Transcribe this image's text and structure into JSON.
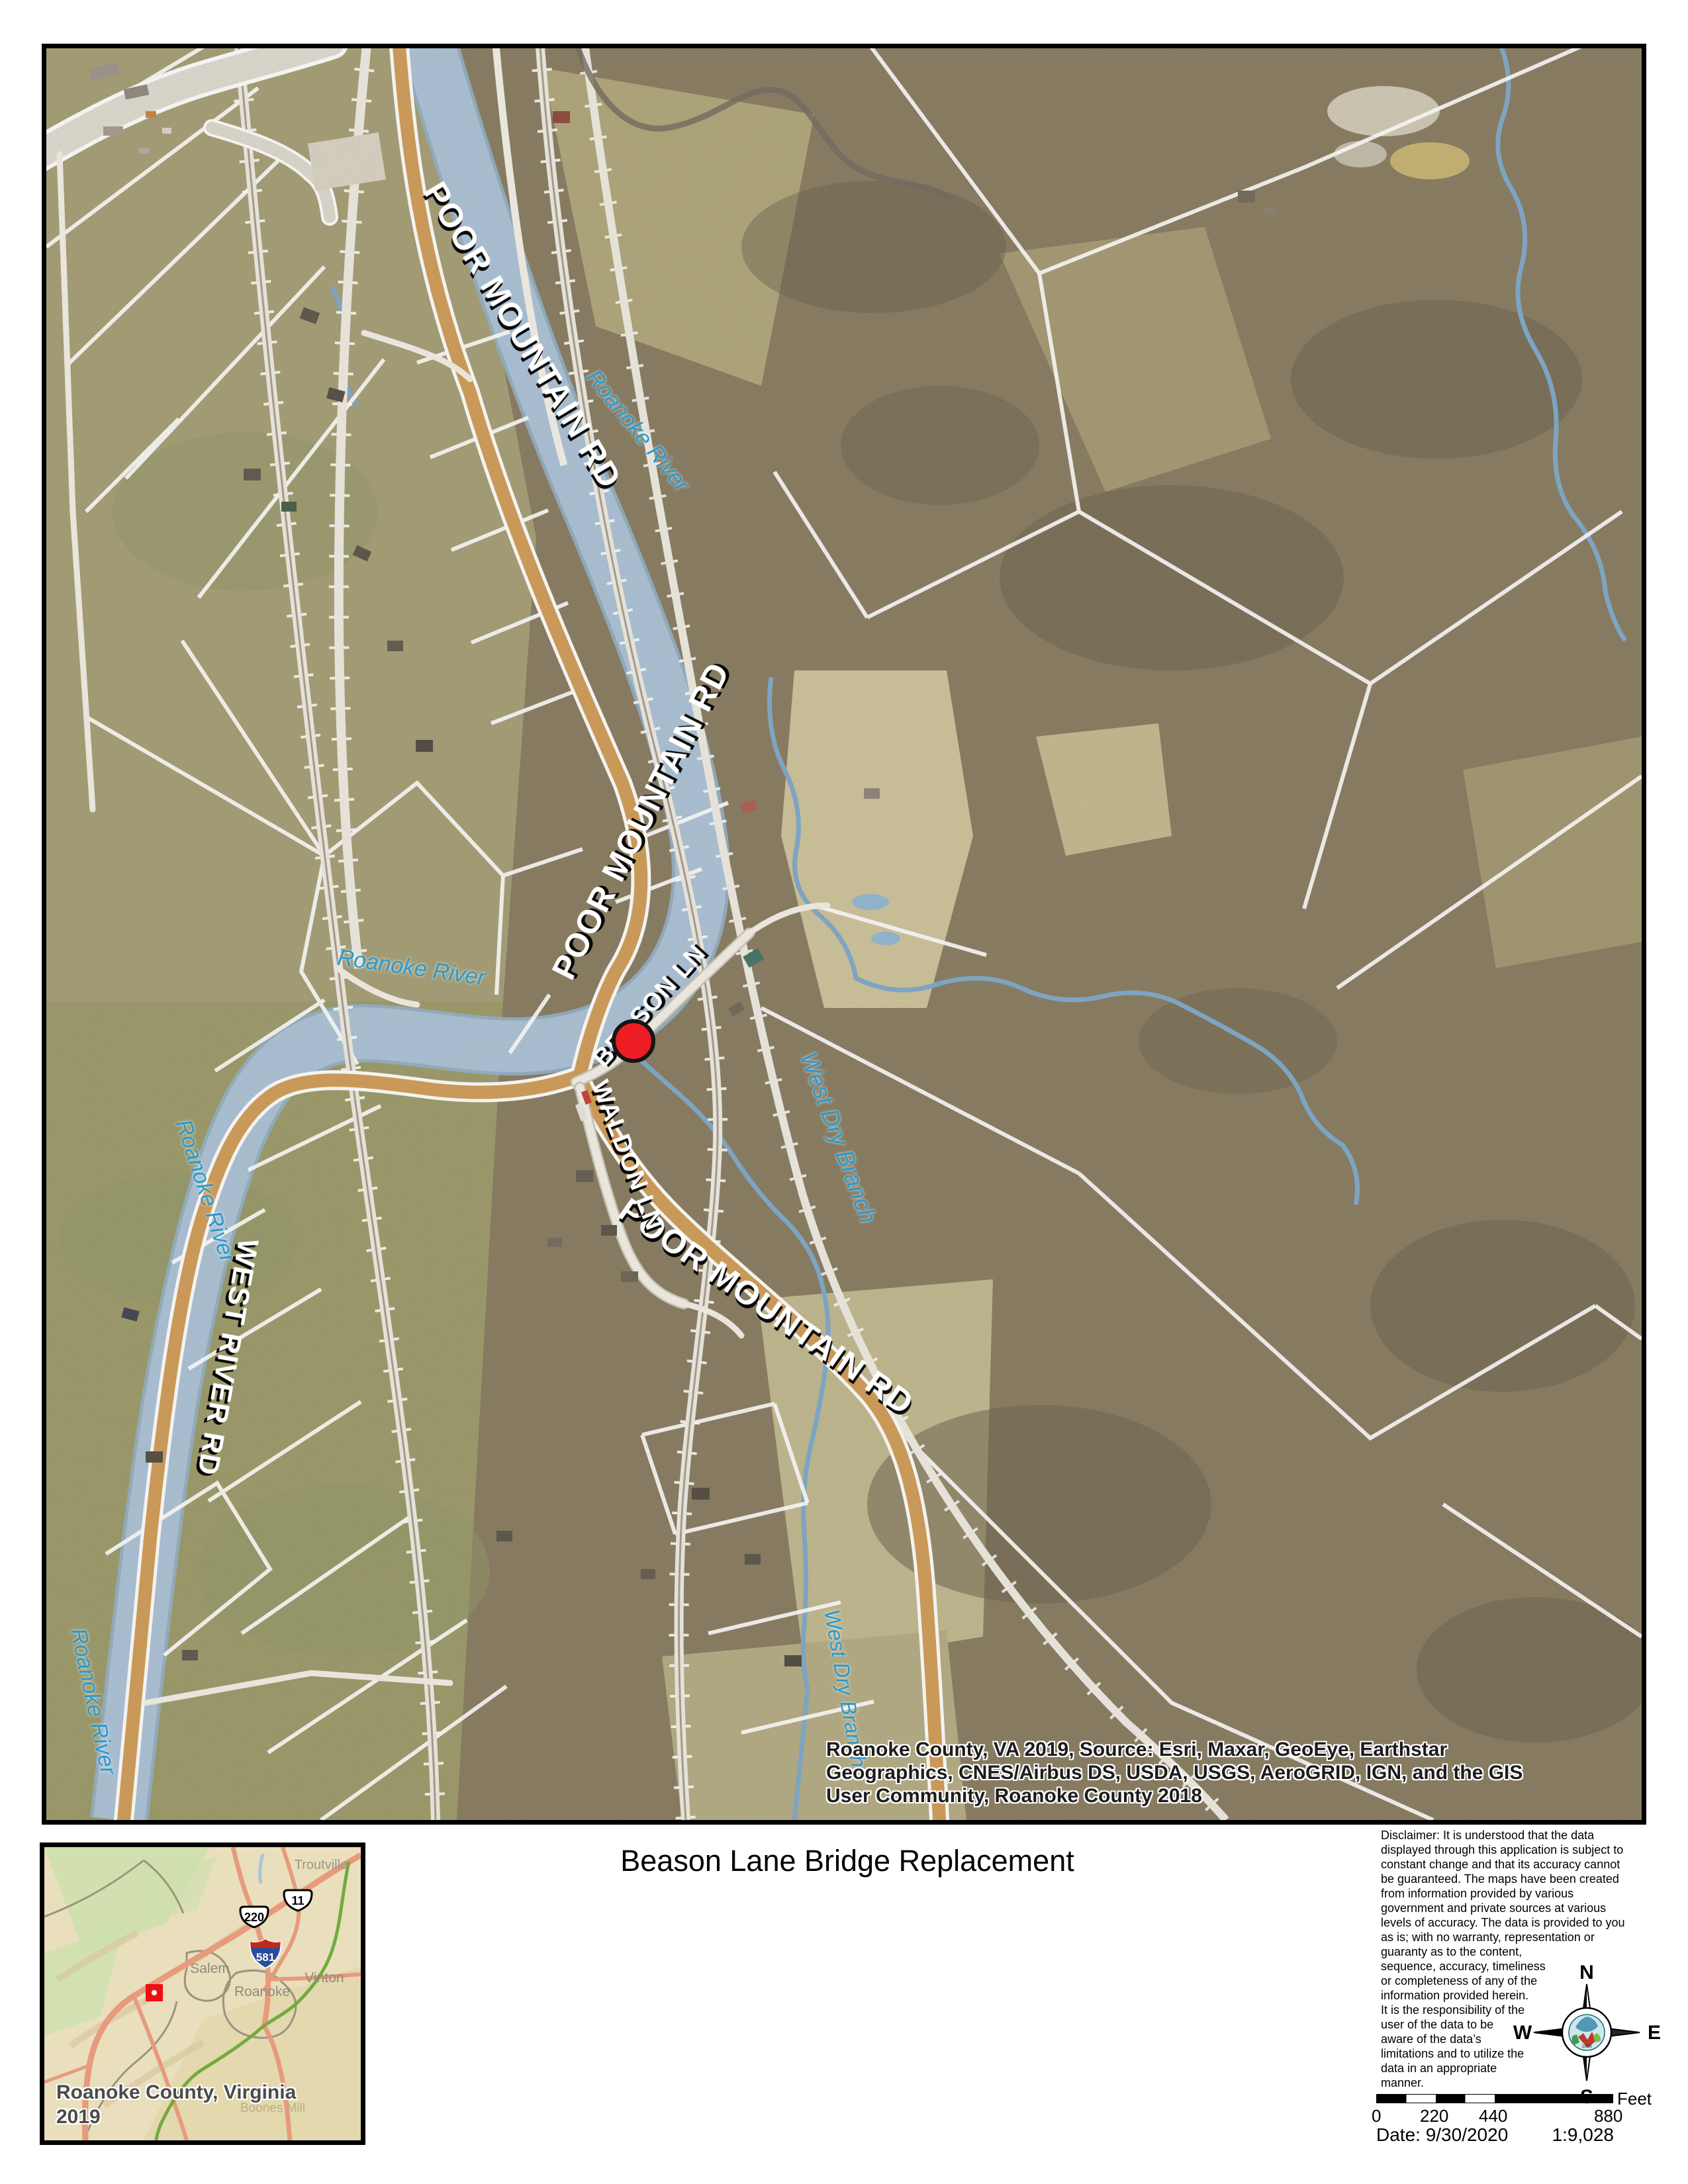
{
  "title": "Beason Lane Bridge Replacement",
  "map": {
    "attribution": "Roanoke County, VA 2019, Source: Esri, Maxar, GeoEye, Earthstar\nGeographics, CNES/Airbus DS, USDA, USGS, AeroGRID, IGN, and the GIS\nUser Community, Roanoke County 2018",
    "labels": {
      "poor_mountain_rd_1": "POOR MOUNTAIN RD",
      "poor_mountain_rd_2": "POOR MOUNTAIN RD",
      "poor_mountain_rd_3": "POOR MOUNTAIN RD",
      "west_river_rd": "WEST RIVER RD",
      "waldon_ln": "WALDON LN",
      "beason_ln": "BEASON LN",
      "roanoke_river_1": "Roanoke River",
      "roanoke_river_2": "Roanoke River",
      "roanoke_river_3": "Roanoke River",
      "roanoke_river_4": "Roanoke River",
      "west_dry_branch_1": "West Dry Branch",
      "west_dry_branch_2": "West Dry Branch"
    },
    "marker_color": "#ee1c23"
  },
  "inset": {
    "caption": "Roanoke County, Virginia\n2019",
    "labels": {
      "troutville": "Troutville",
      "salem": "Salem",
      "roanoke": "Roanoke",
      "vinton": "Vinton",
      "boones_mill": "Boones Mill"
    },
    "shields": {
      "us220": "220",
      "us11": "11",
      "i581": "581"
    }
  },
  "disclaimer": "Disclaimer: It is understood that the data\ndisplayed through this application is subject to\nconstant change and that its accuracy cannot\nbe guaranteed. The maps have been created\nfrom information provided by various\ngovernment and private sources at various\nlevels of accuracy. The data is provided to you\nas is; with no warranty, representation or\nguaranty as to the content,\nsequence, accuracy, timeliness\nor completeness of any of the\ninformation provided herein.\nIt is the responsibility of the\nuser of the data to be\naware of the data’s\nlimitations and to utilize the\ndata in an appropriate\nmanner.",
  "compass": {
    "north": "N",
    "south": "S",
    "east": "E",
    "west": "W"
  },
  "scale_bar": {
    "tick_0": "0",
    "tick_220": "220",
    "tick_440": "440",
    "tick_880": "880",
    "unit": "Feet"
  },
  "footer": {
    "date": "Date: 9/30/2020",
    "ratio": "1:9,028"
  }
}
